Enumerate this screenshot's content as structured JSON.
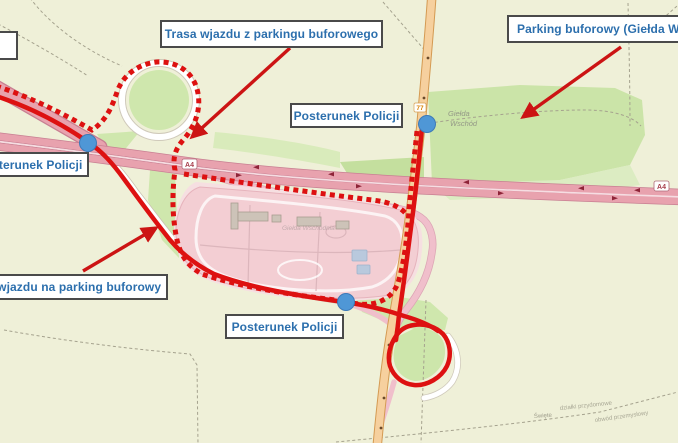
{
  "annotations": {
    "boxes": [
      {
        "id": "top-center",
        "text": "Trasa wjazdu z parkingu buforowego"
      },
      {
        "id": "top-right",
        "text": "Parking buforowy (Giełda Wsc"
      },
      {
        "id": "mid-right",
        "text": "Posterunek Policji"
      },
      {
        "id": "left-edge",
        "text": "Posterunek Policji"
      },
      {
        "id": "left-lower",
        "text": "Trasa wjazdu na parking buforowy"
      },
      {
        "id": "bottom",
        "text": "Posterunek Policji"
      }
    ],
    "route_color": "#dd1111",
    "label_text_color": "#2c6fad",
    "police_marker_color": "#4f97d6",
    "police_marker_count": 3
  },
  "map": {
    "highway_shield": "A4",
    "road_number": "77",
    "area_label_line1": "Giełda",
    "area_label_line2": "Wschód",
    "parking_faint_label": "Giełda Wschodnia",
    "tiny_label_1": "Święte",
    "tiny_label_2": "działki przydomowe",
    "tiny_label_3": "obwód przemysłowy",
    "colors": {
      "background": "#eff0d8",
      "grass": "#cfe7ad",
      "motorway": "#e8a2ae",
      "primary_road": "#f6d09e",
      "parking_area": "#f3ced3"
    }
  }
}
